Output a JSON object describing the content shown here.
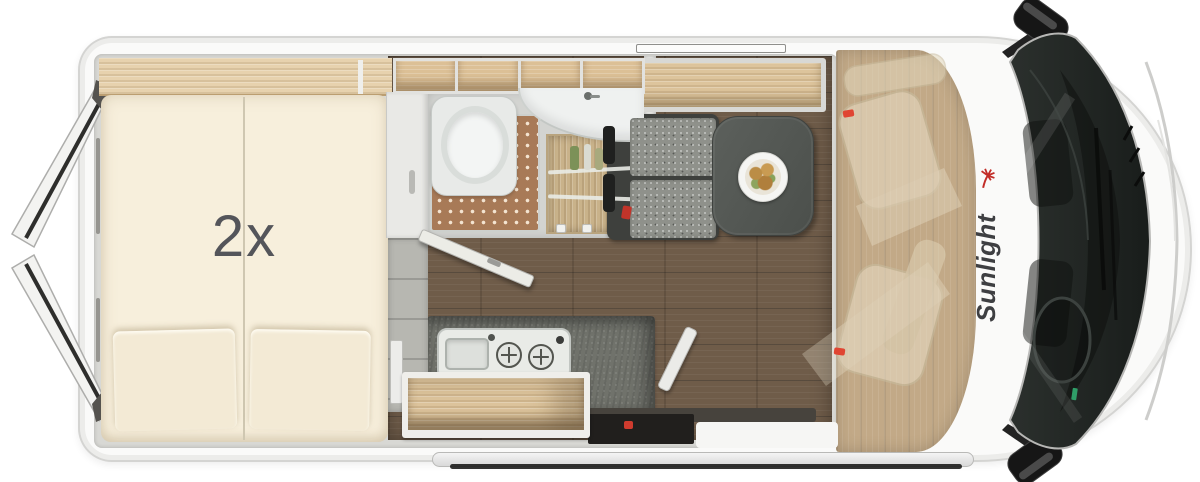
{
  "labels": {
    "bed_quantity": "2x"
  },
  "branding": {
    "name": "Sunlight",
    "logo_text_color": "#3e3f42",
    "palm_icon_color": "#c22d28"
  },
  "icons": {
    "palm-tree-icon": "svg-red-palm",
    "plate-of-food-icon": "css-radial-food-circles",
    "toilet-icon": "css-circle-bowl",
    "corner-sink-icon": "css-quarter-ellipse",
    "shower-mat-icon": "css-dot-grid",
    "burner-icon": "css-cross-circle",
    "sink-stove-combo-icon": "css-rounded-panel",
    "side-mirror-icon": "svg-rounded-blob",
    "rear-door-icon": "svg-open-door-polygon",
    "windshield-icon": "svg-dark-glass",
    "swivel-seat-ghost-icon": "svg-translucent-seat",
    "entry-step-icon": "css-running-board"
  },
  "colors": {
    "body": "#fafaf9",
    "wall": "#d8d8d4",
    "mattress": "#f7efdc",
    "wood_shelf": "#e7d2ae",
    "wood_locker": "#dcc096",
    "floor_living": "#6f5c49",
    "floor_cab": "#c2a987",
    "counter": "#70726b",
    "table": "#565a57",
    "bench_cushion": "#8f918b",
    "shower_mat": "#a87a57",
    "ceramic": "#f3f5f4",
    "windshield": "#202523",
    "accent_red": "#e04532"
  }
}
